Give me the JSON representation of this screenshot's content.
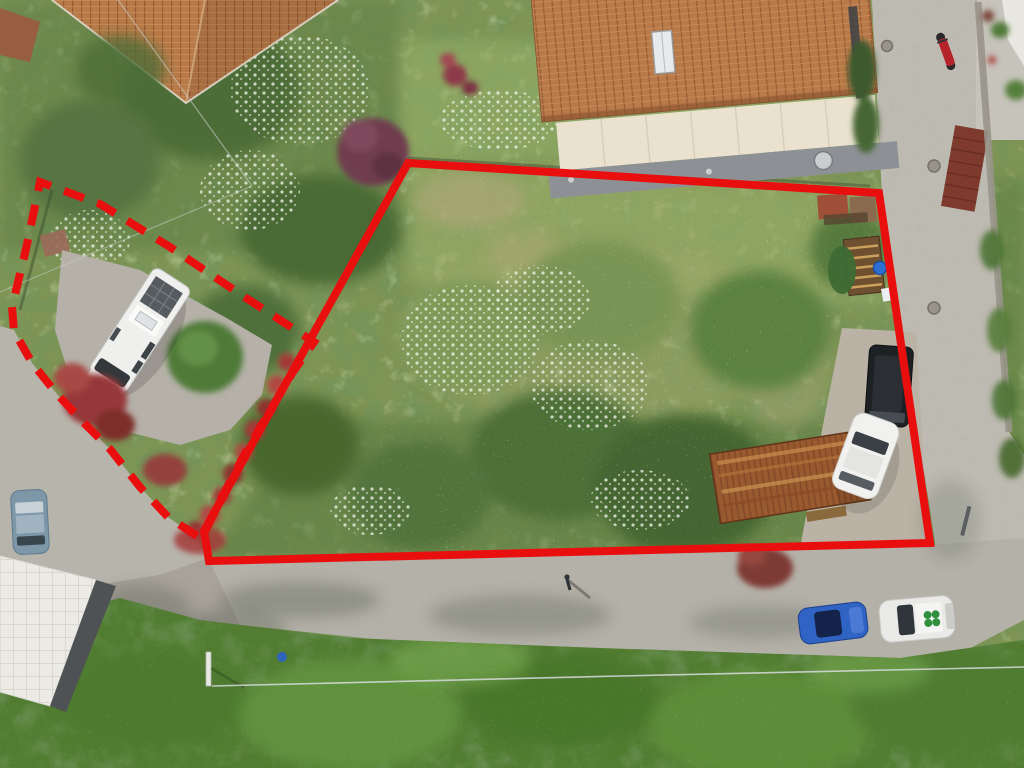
{
  "meta": {
    "description": "Aerial drone photograph of a residential land plot outlined with a red solid boundary, with an adjacent camper parking area outlined with a red dashed boundary"
  },
  "annotation": {
    "color": "#e90f0f",
    "stroke_width": "8",
    "dash_pattern": "21 14",
    "solid_points": "408,163 879,193 930,543 209,561 204,531",
    "dashed_path": "M197,536 L168,517 L140,487 L110,449 L85,424 L57,394 L32,363 L14,331 L12,307 L26,249 L40,182 L100,204 L170,247 L240,294 L314,342 L293,372 L268,414 L243,457 L222,497 L203,536"
  },
  "scene": {
    "setting": "top-down view of overgrown plot, gravel roads, gardens and houses",
    "objects": [
      "terracotta gable-roof house",
      "hip-roof house",
      "white camper van on concrete pad",
      "round bush",
      "red flower hedge",
      "purple ornamental tree",
      "rusty corrugated metal shed",
      "wooden pallet shed with green tarp",
      "blue barrel",
      "black van",
      "white car in plot",
      "blue-gray hatchback",
      "blue car on road",
      "white car with green clover roof logo",
      "red moped",
      "white tiled roof building",
      "gravel road junction",
      "utility wires",
      "manhole covers",
      "pedestrian"
    ]
  },
  "vehicles": {
    "camper_body": "#eff0ee",
    "black_van": "#1e2124",
    "white_car_plot": "#f1f1ef",
    "hatchback_left": "#7d97a9",
    "blue_car": "#2f63c4",
    "white_car_road": "#e9eae8",
    "clover_logo": "#2f8f3f",
    "moped": "#b5242b"
  }
}
